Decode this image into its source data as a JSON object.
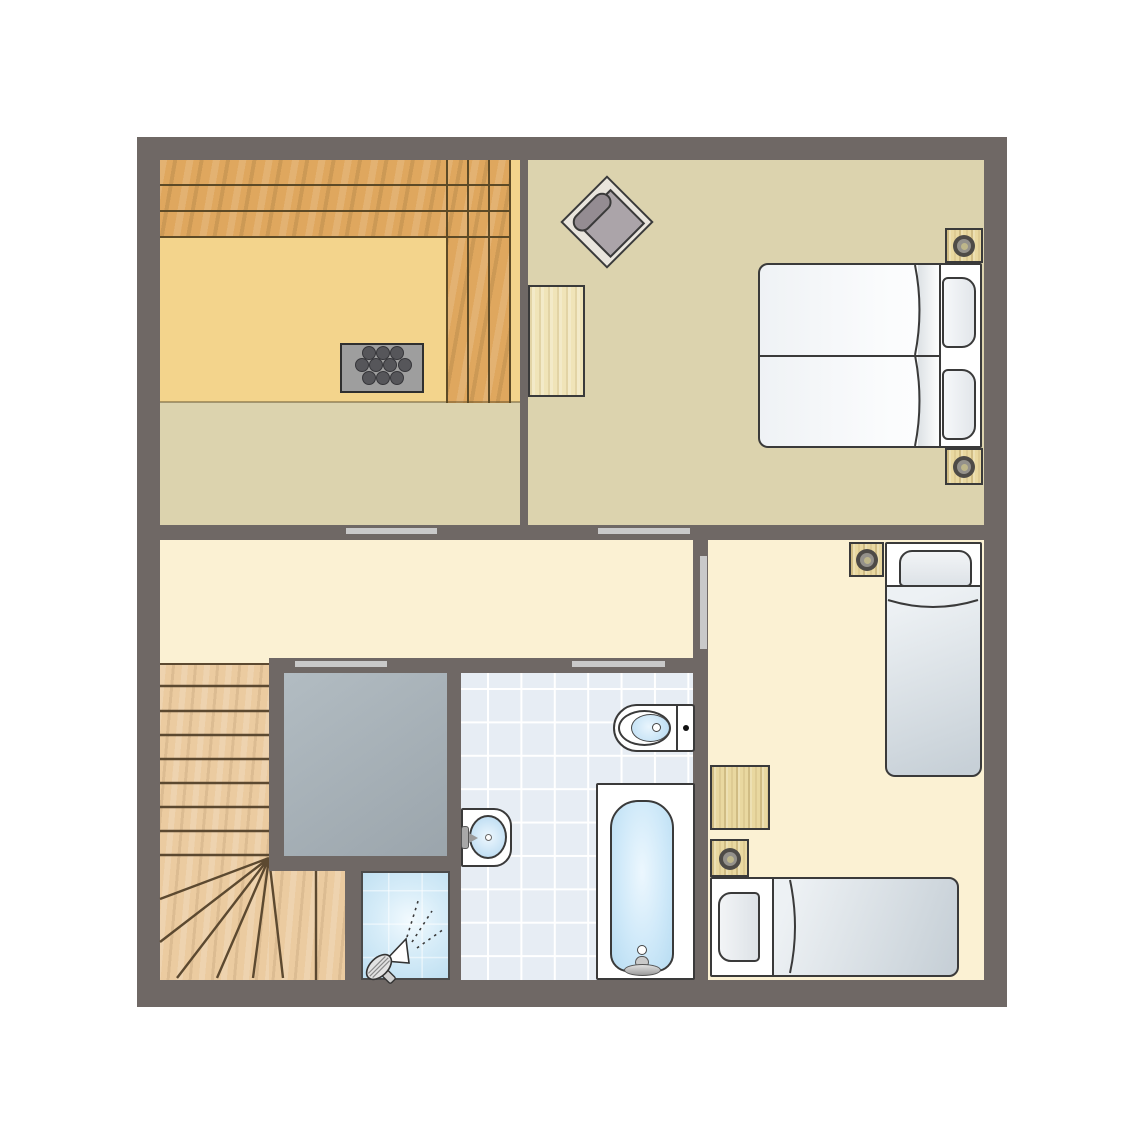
{
  "title": "first-floor-plan",
  "palette": {
    "wall": "#6F6865",
    "canvas": "#FFFFFF",
    "sand": "#F3D48C",
    "khaki": "#DCD3AE",
    "cream": "#FBF1D3",
    "benchWood": "#DFA75E",
    "benchLine": "#5D4A26",
    "stairWood": "#EBCBA0",
    "stairLine": "#5C4930",
    "voidFill": "#A9B3B9",
    "tileFloor": "#E7EDF4",
    "tileLine": "#FFFFFF",
    "showerBlue": "#BDDFF2",
    "doorBar": "#C9C9C9",
    "outline": "#3A3A3A",
    "mattressLight": "#EDF1F4",
    "mattressShade": "#C7D0D7",
    "pillowFill": "#E4E8EC",
    "waterLight": "#E9F5FD",
    "waterBlue": "#AED6EE",
    "gray": "#9E9E9E",
    "stone": "#56565A",
    "chairFrame": "#E9E5DD",
    "chairSeat": "#ABA4A9",
    "chairCushion": "#948C92",
    "furnWood": "#E9D8A0",
    "furnWoodPale": "#F0E4B8",
    "lampOuter": "#4E4B47",
    "lampMid": "#94918B",
    "lampCenter": "#BEB68A"
  },
  "rooms": [
    {
      "name": "sauna-room",
      "position": "top-left",
      "floor": "sand with khaki strip",
      "fixtures": [
        "tiered-bench-top-3-levels",
        "tiered-bench-right-3-levels",
        "sauna-heater-10-stones"
      ]
    },
    {
      "name": "double-bedroom",
      "position": "top-right",
      "floor": "khaki",
      "fixtures": [
        "armchair-rotated-45",
        "desk",
        "double-bed-2-mattresses-2-pillows",
        "nightstand-lamp",
        "nightstand-lamp"
      ]
    },
    {
      "name": "hallway-landing",
      "position": "middle-left",
      "floor": "cream",
      "fixtures": []
    },
    {
      "name": "staircase",
      "position": "bottom-left",
      "floor": "wood",
      "fixtures": [
        "straight-flight-8-treads",
        "winder-fan-6-lines",
        "lower-flight-2-treads"
      ]
    },
    {
      "name": "void-stairwell",
      "position": "bottom-center-left",
      "floor": "blue-gray",
      "fixtures": []
    },
    {
      "name": "shower-cell",
      "position": "bottom-center",
      "floor": "light-blue-tile",
      "fixtures": [
        "shower-head-with-spray"
      ]
    },
    {
      "name": "bathroom",
      "position": "bottom-center-right",
      "floor": "blue-tiles",
      "fixtures": [
        "toilet-with-cistern",
        "washbasin-with-tap",
        "bathtub-with-faucet"
      ]
    },
    {
      "name": "twin-bedroom",
      "position": "right",
      "floor": "cream",
      "fixtures": [
        "single-bed-vertical",
        "single-bed-horizontal",
        "nightstand-lamp",
        "nightstand-lamp",
        "side-table"
      ]
    }
  ],
  "doors": [
    {
      "name": "door-hall-to-sauna",
      "orientation": "horizontal"
    },
    {
      "name": "door-hall-to-double-bedroom",
      "orientation": "horizontal"
    },
    {
      "name": "door-hall-to-void",
      "orientation": "horizontal"
    },
    {
      "name": "door-hall-to-bathroom",
      "orientation": "horizontal"
    },
    {
      "name": "door-hall-to-twin-bedroom",
      "orientation": "vertical"
    }
  ],
  "counts": {
    "sauna_stones": 10,
    "straight_treads": 8,
    "fan_lines": 6,
    "double_beds": 1,
    "single_beds": 2,
    "lamps": 4,
    "pillows": 4
  }
}
